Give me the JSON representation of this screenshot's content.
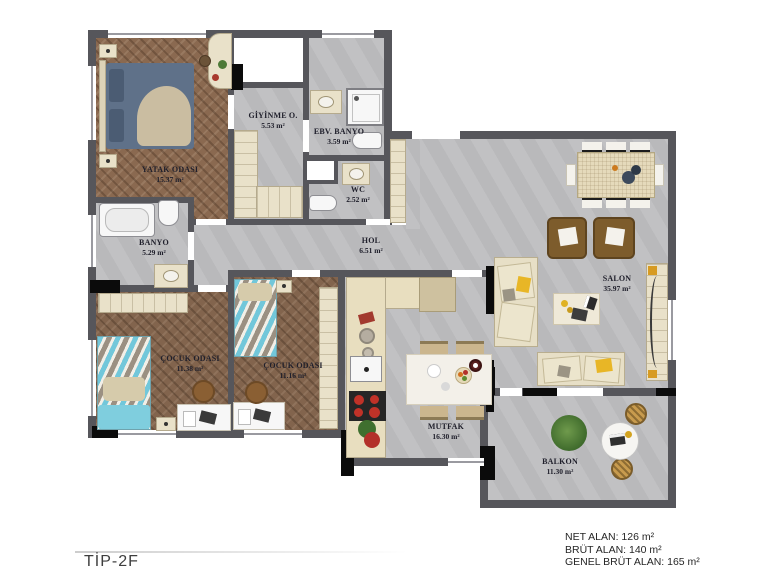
{
  "plan": {
    "title": "TİP-2F",
    "rooms": [
      {
        "id": "yatak-odasi",
        "name": "YATAK ODASI",
        "area": "15.37 m²"
      },
      {
        "id": "giyinme-odasi",
        "name": "GİYİNME O.",
        "area": "5.53 m²"
      },
      {
        "id": "ebeveyn-banyo",
        "name": "EBV. BANYO",
        "area": "3.59 m²"
      },
      {
        "id": "wc",
        "name": "WC",
        "area": "2.52 m²"
      },
      {
        "id": "banyo",
        "name": "BANYO",
        "area": "5.29 m²"
      },
      {
        "id": "hol",
        "name": "HOL",
        "area": "6.51 m²"
      },
      {
        "id": "cocuk-odasi-1",
        "name": "ÇOCUK ODASI",
        "area": "11.38 m²"
      },
      {
        "id": "cocuk-odasi-2",
        "name": "ÇOCUK ODASI",
        "area": "11.16 m²"
      },
      {
        "id": "mutfak",
        "name": "MUTFAK",
        "area": "16.30 m²"
      },
      {
        "id": "salon",
        "name": "SALON",
        "area": "35.97 m²"
      },
      {
        "id": "balkon",
        "name": "BALKON",
        "area": "11.30 m²"
      }
    ],
    "summary": {
      "net_alan": "NET ALAN: 126 m²",
      "brut_alan": "BRÜT ALAN: 140 m²",
      "genel_brut_alan": "GENEL BRÜT ALAN: 165 m²"
    },
    "colors": {
      "wall": "#56565b",
      "column_black": "#0b0b0b",
      "floor_gray": "#bdbdbf",
      "wood": "#8a6950",
      "furniture_cream": "#e7dfc6",
      "accent_yellow": "#e8b626",
      "armchair_brown": "#7d5c2c",
      "master_bed_blue": "#5f7189",
      "kids_bed_teal": "#72c7da"
    }
  }
}
